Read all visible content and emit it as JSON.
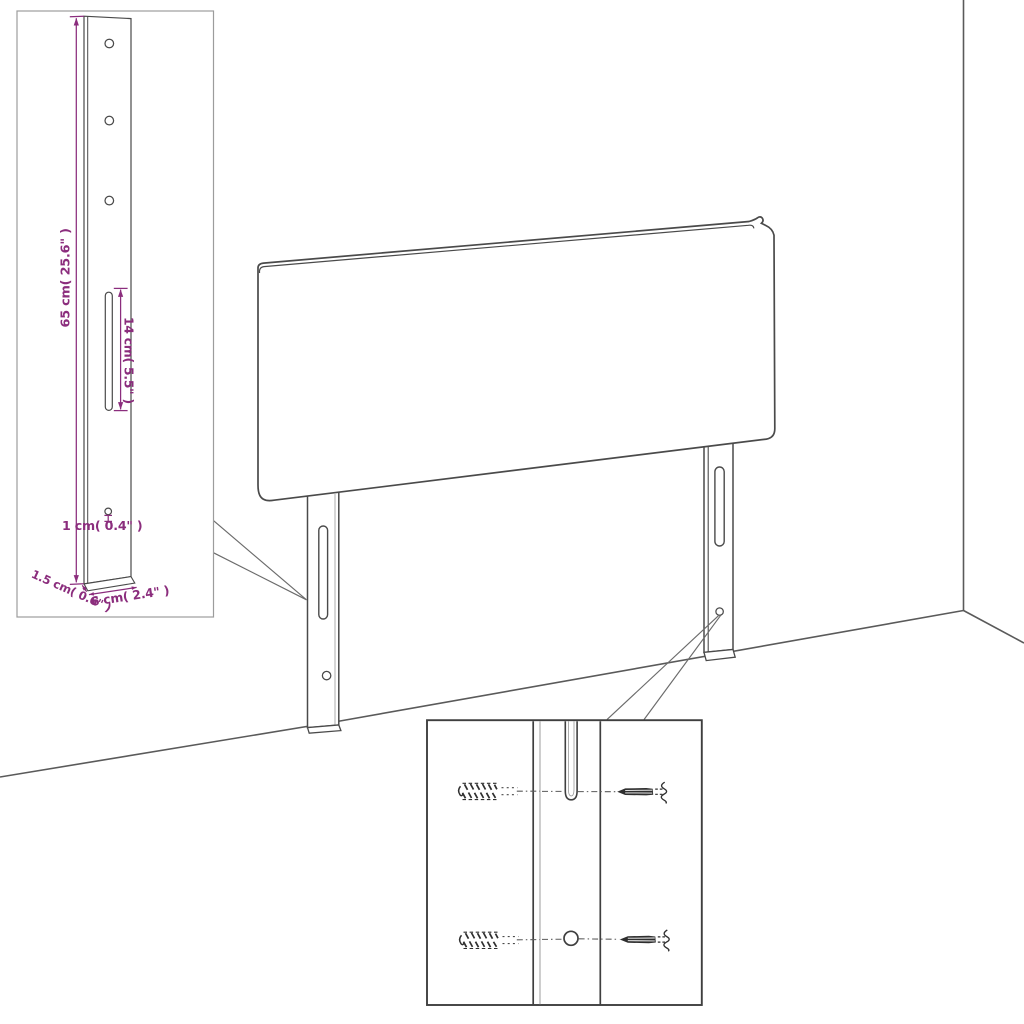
{
  "page": {
    "background": "#ffffff",
    "subject": "Headboard with legs - assembly and dimension diagram"
  },
  "colors": {
    "line": "#4a4a4a",
    "line_light": "#949494",
    "dimension_purple": "#8b2d7d",
    "inset_border_light": "#9c9c9c",
    "detail_border_dark": "#3f3f3f"
  },
  "labels": {
    "bracket_height": "65 cm( 25.6\" )",
    "slot_length": "14 cm( 5.5\" )",
    "hole_diameter": "1 cm( 0.4\" )",
    "bracket_depth": "1.5 cm( 0.6\" )",
    "bracket_width": "6 cm( 2.4\" )"
  }
}
